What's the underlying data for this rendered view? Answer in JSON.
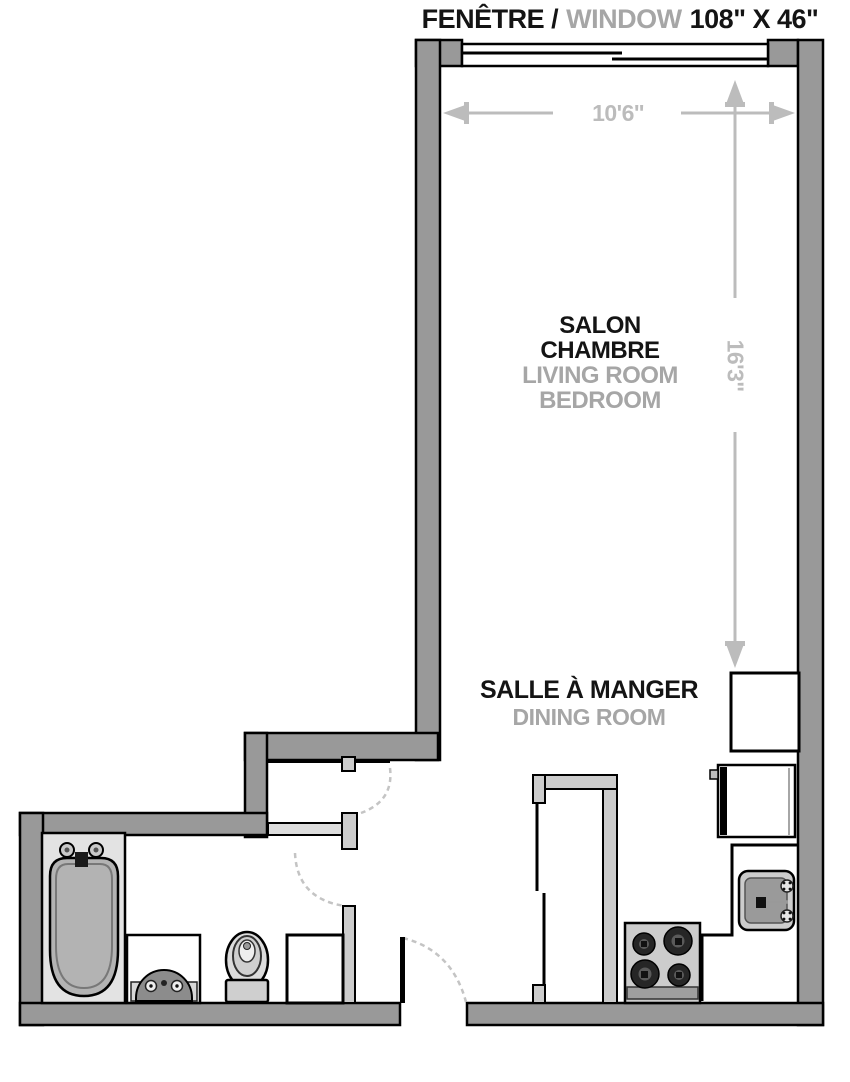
{
  "title": {
    "french": "FENÊTRE /",
    "english": "WINDOW",
    "size": "108\" X 46\""
  },
  "labels": {
    "living": {
      "fr1": "SALON",
      "fr2": "CHAMBRE",
      "en1": "LIVING ROOM",
      "en2": "BEDROOM"
    },
    "dining": {
      "fr": "SALLE À MANGER",
      "en": "DINING ROOM"
    }
  },
  "dimensions": {
    "room_width": "10'6''",
    "room_height": "16'3''"
  },
  "colors": {
    "wall_fill": "#999999",
    "interior_wall_fill": "#cccccc",
    "outline": "#000000",
    "dim_color": "#bcbcbc",
    "label_primary": "#141414",
    "label_secondary": "#a6a6a6",
    "fixture_light": "#cccccc",
    "fixture_mid": "#9a9a9a",
    "floor": "#ffffff"
  }
}
